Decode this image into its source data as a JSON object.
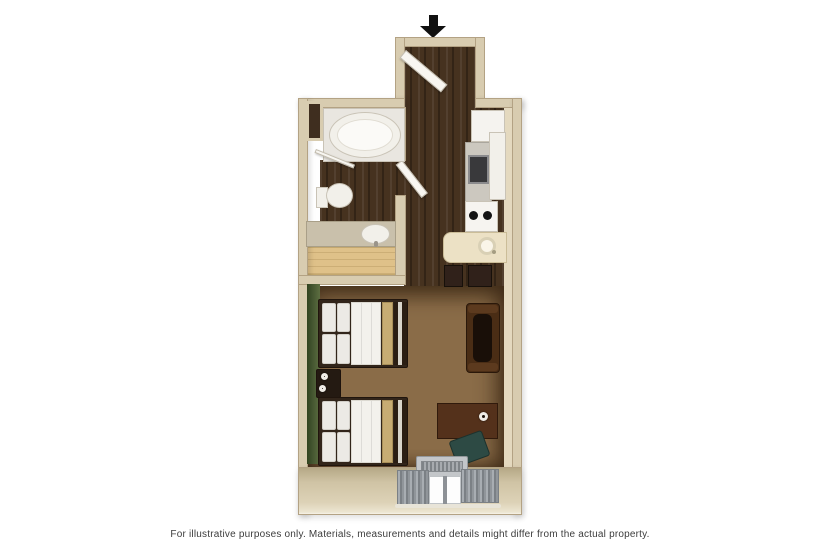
{
  "page": {
    "footnote": "For illustrative purposes only.  Materials, measurements and details might differ from the actual property."
  },
  "icons": {
    "entry_arrow": "arrow-down",
    "bed_lamp": "lamp-top-view",
    "desk_lamp": "lamp-top-view"
  },
  "colors": {
    "wall": "#d8ccb0",
    "wall-edge": "#b3a284",
    "wall-face": "#e4d9bf",
    "wood-dark": "#46321f",
    "carpet": "#8a6c48",
    "closet-wood": "#dfc189",
    "accent-green": "#43542f",
    "fixture-white": "#f2f0ea",
    "counter-cream": "#ece1c5",
    "sofa-brown": "#4a2d15",
    "desk-brown": "#54311b",
    "chair-teal": "#2d4a44",
    "ac-silver": "#c3c6c9",
    "curtain-gray": "#8e9296",
    "bed-runner-tan": "#c7ac73",
    "arrow-black": "#111111",
    "footnote-color": "#3c3c3c"
  }
}
